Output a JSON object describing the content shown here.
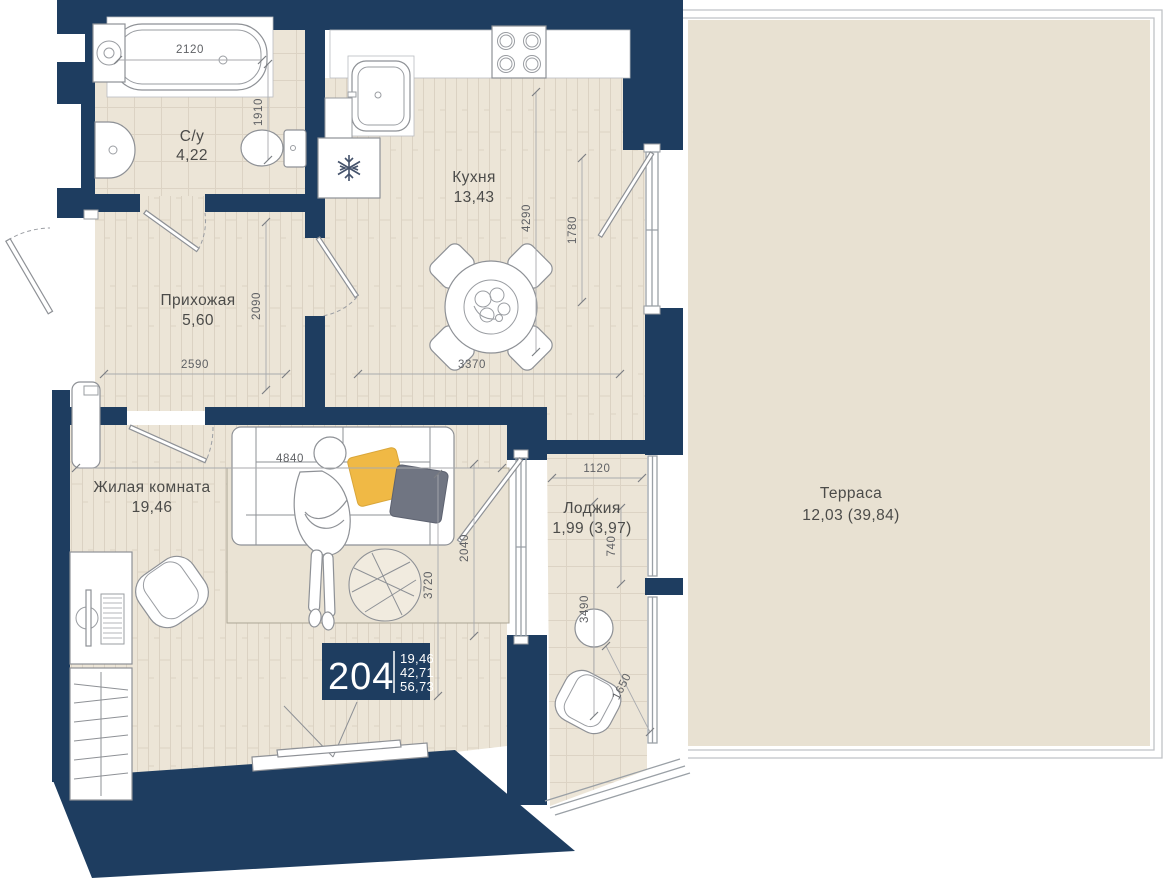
{
  "plan": {
    "badge": {
      "number": "204",
      "areas": [
        "19,46",
        "42,71",
        "56,73"
      ]
    },
    "rooms": [
      {
        "id": "bathroom",
        "name": "С/у",
        "area": "4,22"
      },
      {
        "id": "hallway",
        "name": "Прихожая",
        "area": "5,60"
      },
      {
        "id": "kitchen",
        "name": "Кухня",
        "area": "13,43"
      },
      {
        "id": "living",
        "name": "Жилая комната",
        "area": "19,46"
      },
      {
        "id": "loggia",
        "name": "Лоджия",
        "area": "1,99 (3,97)"
      },
      {
        "id": "terrace",
        "name": "Терраса",
        "area": "12,03 (39,84)"
      }
    ],
    "dims": {
      "bathtub_width": "2120",
      "bathroom_depth": "1910",
      "hallway_width": "2590",
      "hallway_depth": "2090",
      "kitchen_depth": "4290",
      "kitchen_window": "1780",
      "kitchen_width": "3370",
      "living_width": "4840",
      "living_depth": "3720",
      "balcony_door": "2040",
      "loggia_width": "1120",
      "loggia_upper": "740",
      "loggia_length": "3490",
      "loggia_diagonal": "1650"
    },
    "icons": {
      "fridge": "snowflake-icon"
    },
    "colors": {
      "wall": "#1e3d60",
      "floor": "#ece5d7",
      "floor_line": "#dbd2c3",
      "terrace_floor": "#e8e1d2",
      "rug": "#eae3d4",
      "pillow_yellow": "#f0b945",
      "pillow_gray": "#707582",
      "outline": "#8e9196",
      "dim_text": "#5f6165",
      "label_text": "#4b4b49",
      "badge_bg": "#1e3d60",
      "badge_text": "#ffffff"
    }
  }
}
